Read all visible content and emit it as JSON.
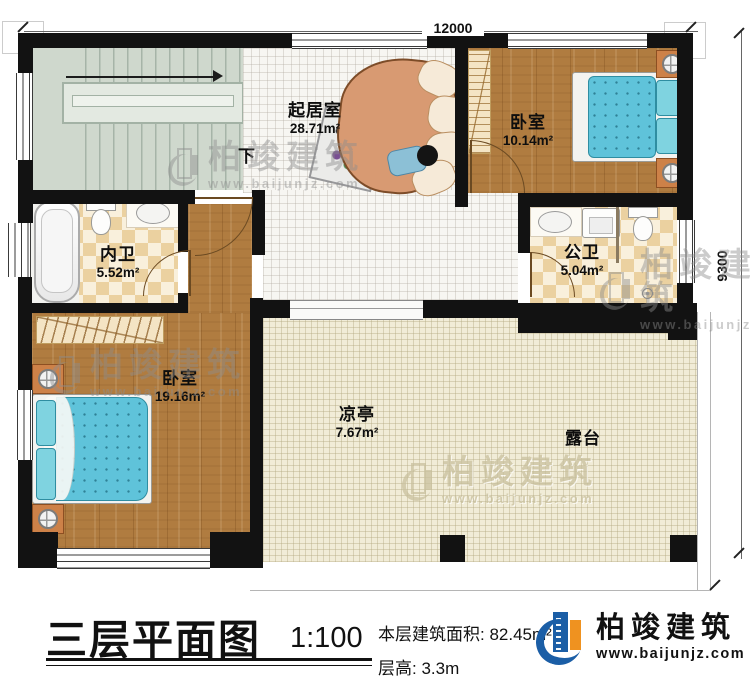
{
  "plan": {
    "dim_top": "12000",
    "dim_right": "9300",
    "stair_down": "下",
    "rooms": {
      "living": {
        "name": "起居室",
        "area": "28.71m²"
      },
      "bedroom_top": {
        "name": "卧室",
        "area": "10.14m²"
      },
      "bath_inner": {
        "name": "内卫",
        "area": "5.52m²"
      },
      "bath_public": {
        "name": "公卫",
        "area": "5.04m²"
      },
      "bedroom_left": {
        "name": "卧室",
        "area": "19.16m²"
      },
      "pavilion": {
        "name": "凉亭",
        "area": "7.67m²"
      },
      "terrace": {
        "name": "露台"
      }
    }
  },
  "watermark": {
    "name": "柏竣建筑",
    "url": "www.baijunjz.com"
  },
  "footer": {
    "title": "三层平面图",
    "scale": "1:100",
    "area_label": "本层建筑面积:",
    "area_value": "82.45m²",
    "height_label": "层高:",
    "height_value": "3.3m"
  },
  "logo": {
    "name": "柏竣建筑",
    "url": "www.baijunjz.com"
  },
  "colors": {
    "wall": "#121212",
    "logo_blue": "#1b5ea6",
    "logo_orange": "#ef9220",
    "bed": "#5fc3da",
    "wood": "#b07c40",
    "checker": "#ebd1a0",
    "stairs": "#cfd8cd",
    "terrace": "#f1ecd7"
  }
}
